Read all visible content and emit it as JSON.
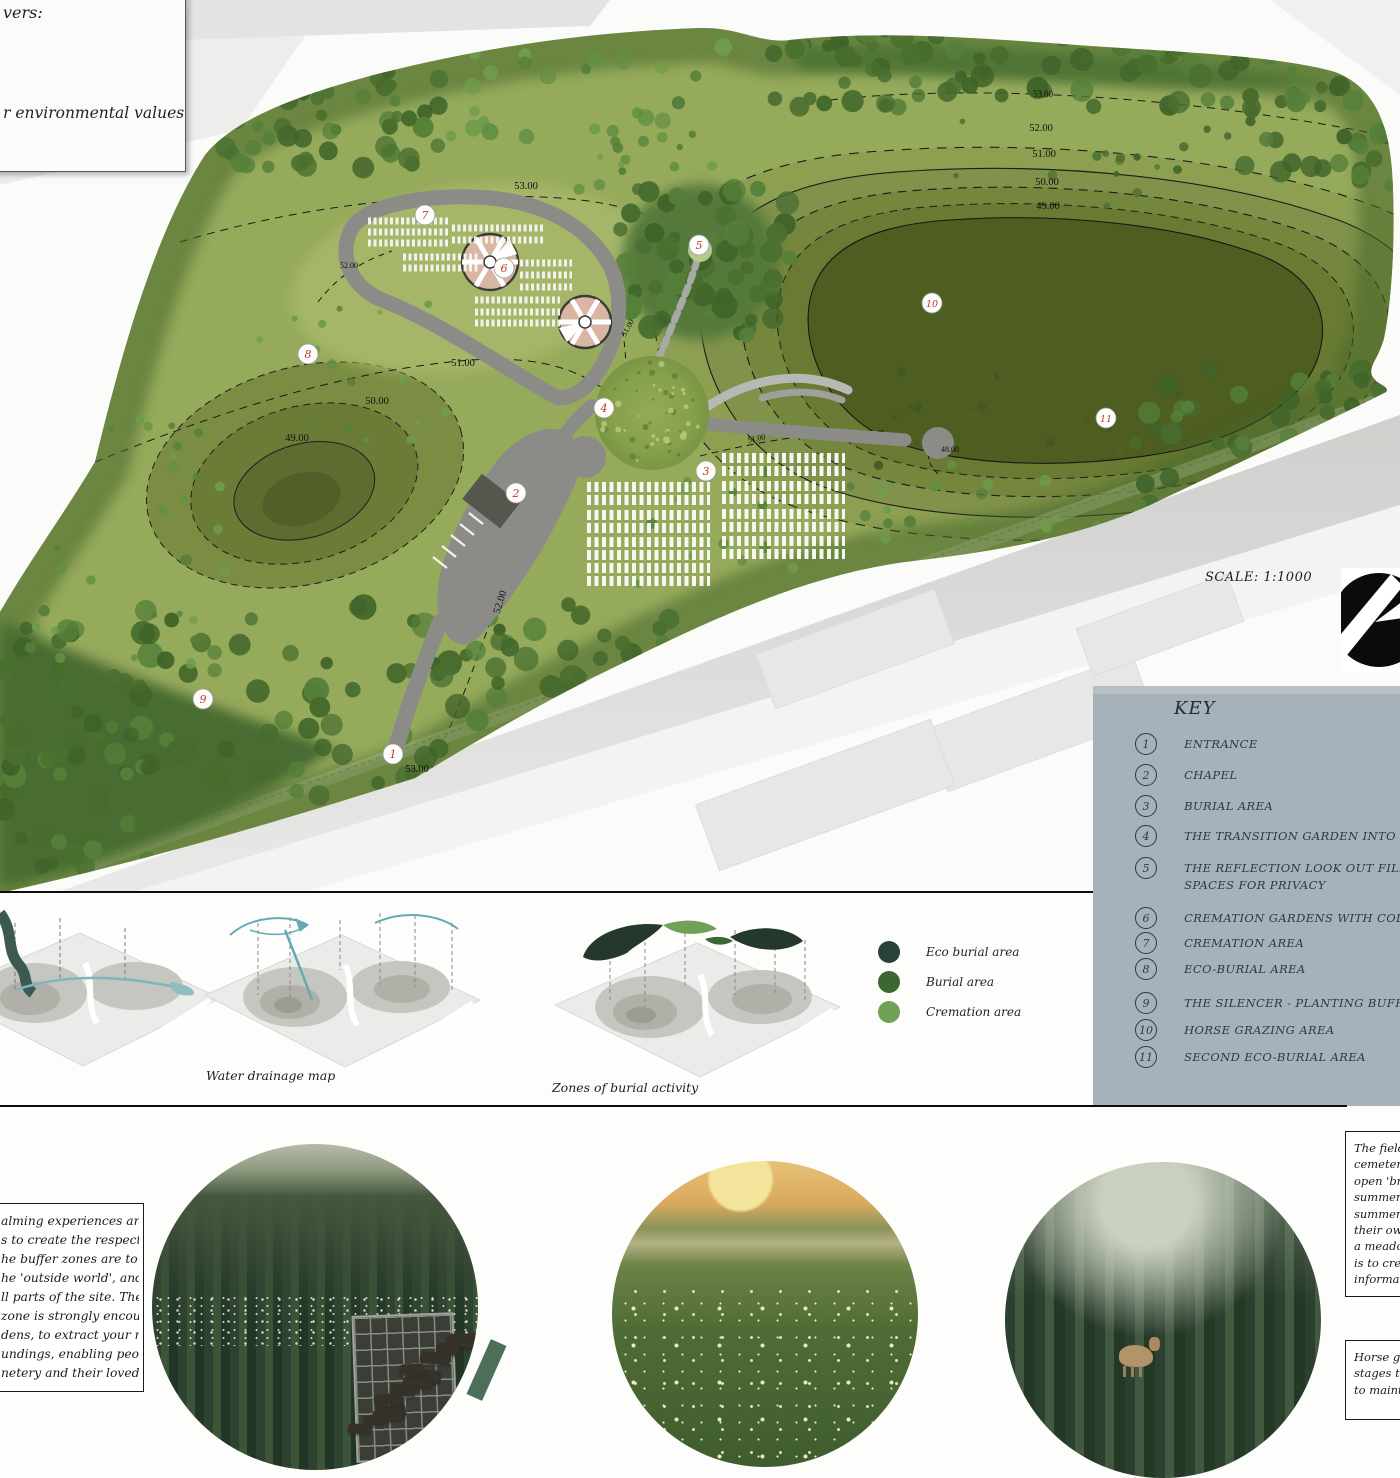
{
  "board": {
    "top_left_box": {
      "line1": "vers:",
      "line2": "r environmental values"
    },
    "scale_label": "SCALE: 1:1000"
  },
  "map": {
    "contour_labels": [
      {
        "text": "53.00",
        "x": 526,
        "y": 189
      },
      {
        "text": "52.00",
        "x": 349,
        "y": 268,
        "size": 8
      },
      {
        "text": "51.00",
        "x": 463,
        "y": 366
      },
      {
        "text": "50.00",
        "x": 377,
        "y": 404
      },
      {
        "text": "49.00",
        "x": 297,
        "y": 441
      },
      {
        "text": "52.00",
        "x": 503,
        "y": 603,
        "rot": -72
      },
      {
        "text": "53.00",
        "x": 417,
        "y": 772
      },
      {
        "text": "53.00",
        "x": 1043,
        "y": 97,
        "size": 9
      },
      {
        "text": "52.00",
        "x": 1041,
        "y": 131
      },
      {
        "text": "51.00",
        "x": 1044,
        "y": 157
      },
      {
        "text": "50.00",
        "x": 1047,
        "y": 185
      },
      {
        "text": "49.00",
        "x": 1048,
        "y": 209
      },
      {
        "text": "48.00",
        "x": 950,
        "y": 452,
        "size": 8
      },
      {
        "text": "51.00",
        "x": 757,
        "y": 441,
        "rot": -12,
        "size": 8
      },
      {
        "text": "51.00",
        "x": 630,
        "y": 329,
        "rot": -62,
        "size": 8
      }
    ],
    "markers": [
      {
        "n": "1",
        "x": 393,
        "y": 754
      },
      {
        "n": "2",
        "x": 516,
        "y": 493
      },
      {
        "n": "3",
        "x": 706,
        "y": 471
      },
      {
        "n": "4",
        "x": 604,
        "y": 408
      },
      {
        "n": "5",
        "x": 699,
        "y": 245
      },
      {
        "n": "6",
        "x": 504,
        "y": 268
      },
      {
        "n": "7",
        "x": 425,
        "y": 215
      },
      {
        "n": "8",
        "x": 308,
        "y": 354
      },
      {
        "n": "9",
        "x": 203,
        "y": 699
      },
      {
        "n": "10",
        "x": 932,
        "y": 303
      },
      {
        "n": "11",
        "x": 1106,
        "y": 418
      }
    ]
  },
  "key": {
    "title": "KEY",
    "items": [
      {
        "num": "1",
        "label": "ENTRANCE",
        "line2": ""
      },
      {
        "num": "2",
        "label": "CHAPEL",
        "line2": ""
      },
      {
        "num": "3",
        "label": "BURIAL AREA",
        "line2": ""
      },
      {
        "num": "4",
        "label": "THE TRANSITION GARDEN INTO THE FIE",
        "line2": ""
      },
      {
        "num": "5",
        "label": "THE REFLECTION LOOK OUT FILLED WIT",
        "line2": "SPACES FOR PRIVACY"
      },
      {
        "num": "6",
        "label": "CREMATION GARDENS WITH COLUMBAR",
        "line2": ""
      },
      {
        "num": "7",
        "label": "CREMATION AREA",
        "line2": ""
      },
      {
        "num": "8",
        "label": "ECO-BURIAL AREA",
        "line2": ""
      },
      {
        "num": "9",
        "label": "THE SILENCER - PLANTING BUFFER",
        "line2": ""
      },
      {
        "num": "10",
        "label": "HORSE GRAZING AREA",
        "line2": ""
      },
      {
        "num": "11",
        "label": "SECOND ECO-BURIAL AREA",
        "line2": ""
      }
    ]
  },
  "diagrams": {
    "captions": {
      "water": "Water drainage map",
      "zones": "Zones of burial activity"
    },
    "legend": [
      {
        "label": "Eco burial area",
        "color": "#2b4239"
      },
      {
        "label": "Burial area",
        "color": "#3c6733"
      },
      {
        "label": "Cremation area",
        "color": "#6fa257"
      }
    ]
  },
  "bottom": {
    "left_box_lines": [
      "alming experiences are",
      "s to create the respectful",
      "he buffer zones are to",
      "he 'outside world', and",
      "ll parts of the site. The",
      "zone is strongly encouraged",
      "dens, to extract your mind",
      "undings, enabling people",
      "netery and their loved"
    ],
    "right_box1_lines": [
      "The field is",
      "cemetery,",
      "open 'brea",
      "summer se",
      "summer w",
      "their own",
      "a meadow",
      "is to create",
      "informalit"
    ],
    "right_box2_lines": [
      "Horse graz",
      "stages to c",
      "to maintai"
    ]
  }
}
